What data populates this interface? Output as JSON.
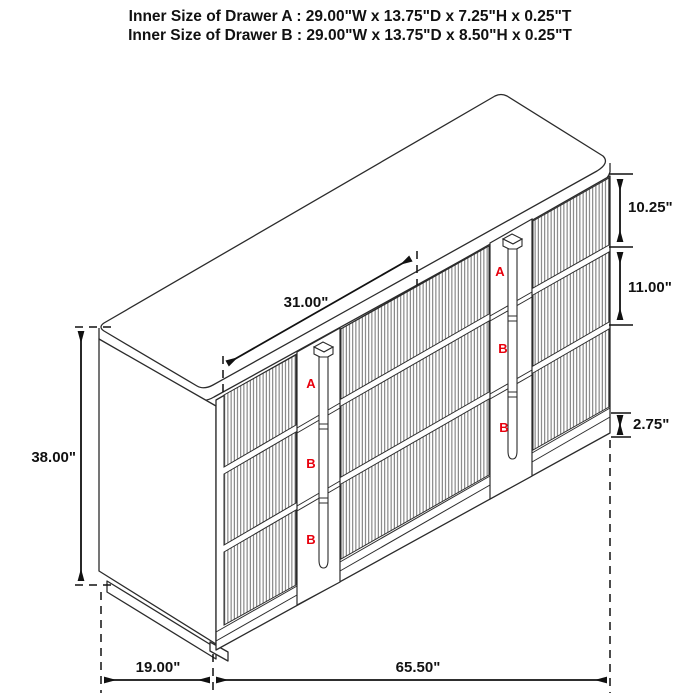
{
  "title": {
    "line1": "Inner Size of Drawer A : 29.00\"W x 13.75\"D x 7.25\"H x 0.25\"T",
    "line2": "Inner Size of Drawer B : 29.00\"W x 13.75\"D x 8.50\"H x 0.25\"T"
  },
  "dimensions": {
    "overall_height": "38.00\"",
    "top_width": "31.00\"",
    "drawer_a_front_height": "10.25\"",
    "drawer_b_front_height": "11.00\"",
    "base_height": "2.75\"",
    "depth": "19.00\"",
    "overall_width": "65.50\""
  },
  "drawer_labels": {
    "left_stile": [
      "A",
      "B",
      "B"
    ],
    "right_stile": [
      "A",
      "B",
      "B"
    ]
  },
  "colors": {
    "line": "#2b2b2b",
    "flute_line": "#606060",
    "drawer_letter_red": "#e8000d",
    "background": "#ffffff"
  }
}
